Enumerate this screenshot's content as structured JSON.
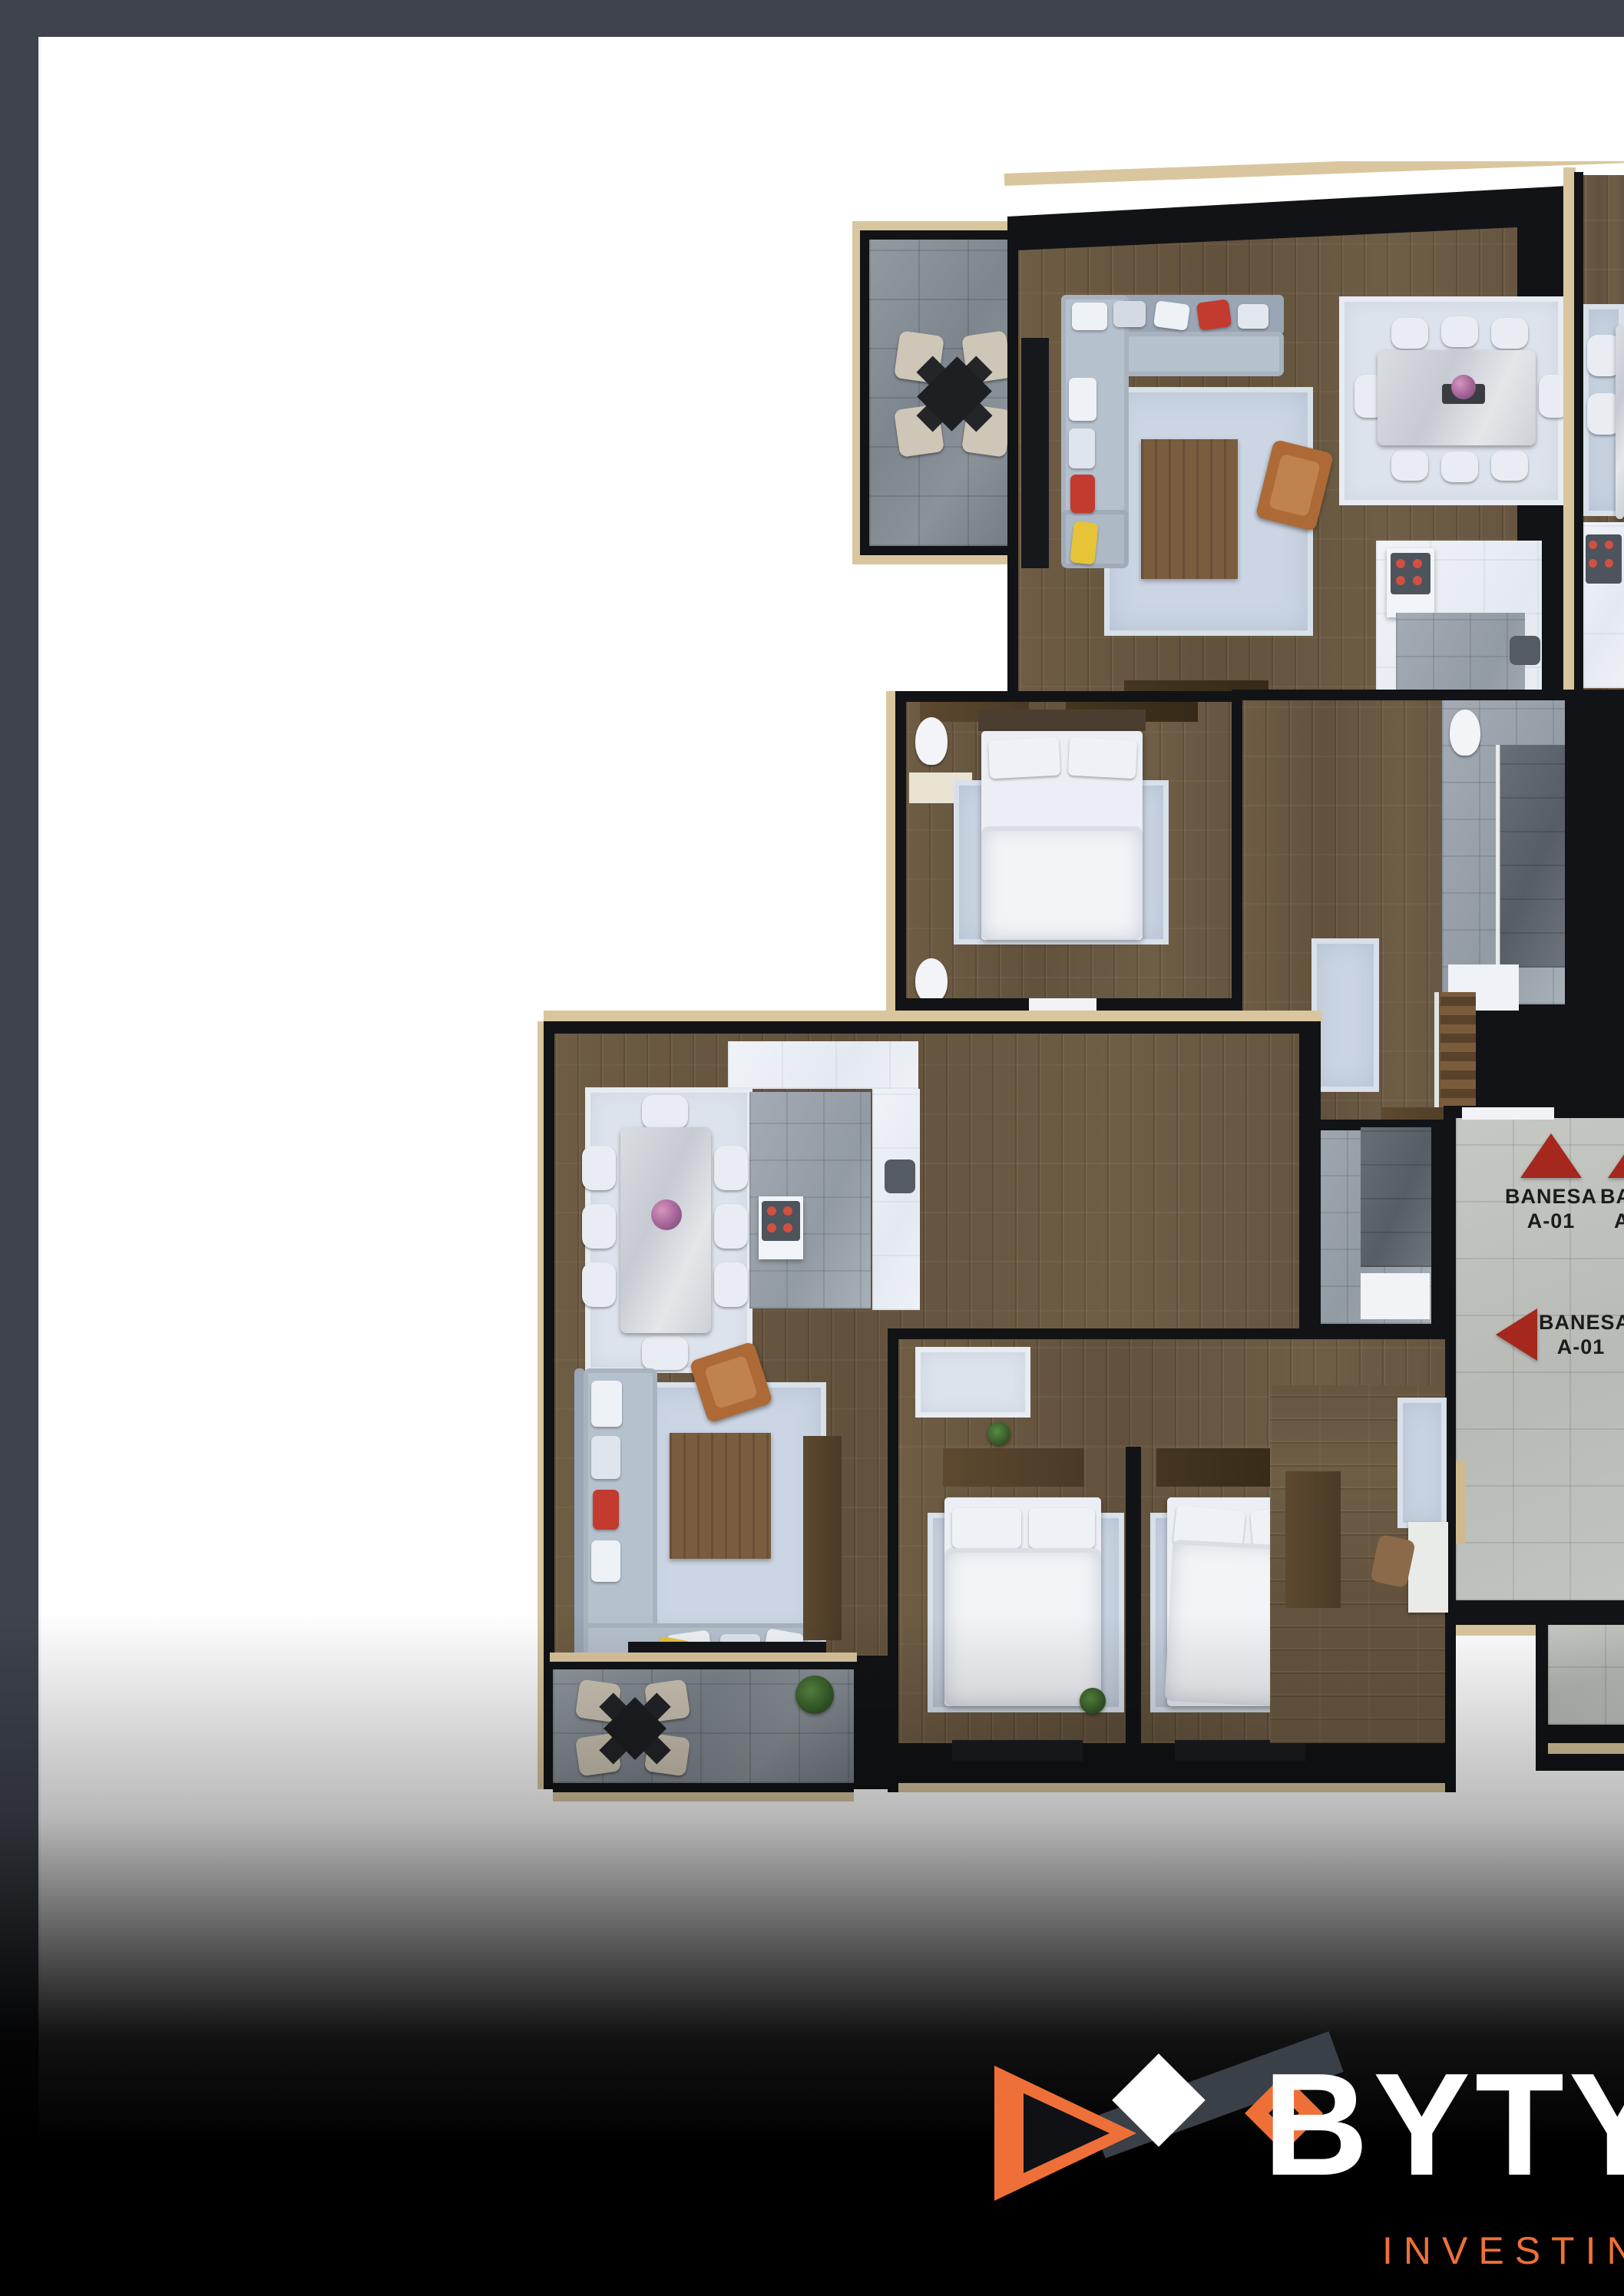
{
  "frame": {
    "color": "#3E434C"
  },
  "floor_plan": {
    "arrow_color": "#A5271D",
    "labels": {
      "banesa_up": {
        "line1": "BANESA",
        "line2": "A-01"
      },
      "banesa_left": {
        "line1": "BANESA",
        "line2": "A-01"
      },
      "banesa_partial": {
        "line1": "BAN",
        "line2": "A-"
      }
    }
  },
  "brand": {
    "name": "BYTYQI",
    "tagline": "INVESTING",
    "name_color": "#FFFFFF",
    "accent": "#EE7038"
  },
  "palette": {
    "wall": "#121316",
    "wood_floor": "#6B5A42",
    "tile_gray": "#9BA4AD",
    "tile_dark": "#60666E",
    "concrete": "#C0C2BE",
    "wood_trim": "#DAC69E",
    "rug": "#CBD5E3",
    "white_floor": "#EDF0F5"
  }
}
